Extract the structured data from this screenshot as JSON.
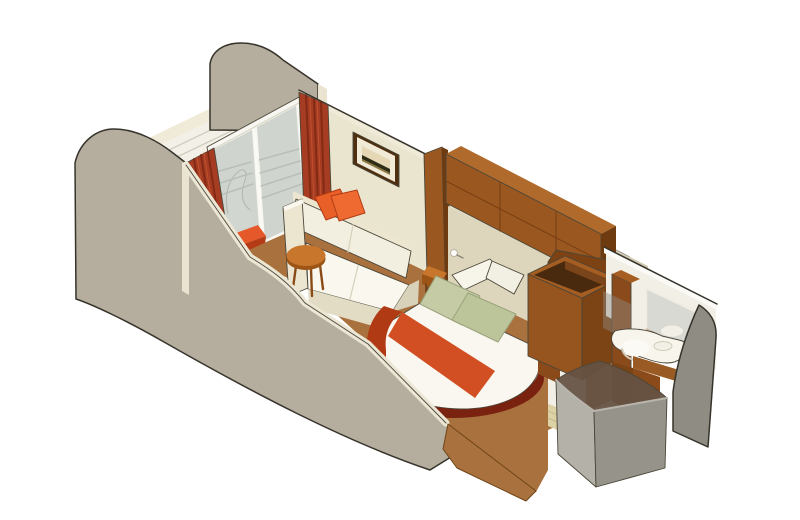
{
  "scene": {
    "type": "isometric-cutaway-illustration",
    "subject": "cruise-ship-balcony-stateroom",
    "objects": [
      "private balcony with slatted deck and curved privacy partitions",
      "sliding glass balcony door with white frame",
      "white lounge chair and orange chair on balcony",
      "red drapes on both sides of balcony door",
      "framed landscape wall art",
      "cream sofa with two orange accent pillows",
      "round wooden coffee table",
      "wood headboard wall with overhead storage cabinets and reading lamp",
      "bedside shelf",
      "bed with white duvet, orange runner, green and white pillows, rounded foot platform",
      "open-top wardrobe / storage unit",
      "bathroom with wood vanity, oval sink and mirror",
      "curved glass shower enclosure",
      "brown carpet in cabin, tiled bathroom floor",
      "cutaway foreground walls"
    ]
  },
  "colors": {
    "bg": "#ffffff",
    "partition": "#b5ae9e",
    "partition_edge": "#e9e3cf",
    "deck": "#f3f1e7",
    "wall": "#eae5cf",
    "wall_dark": "#d2cbb0",
    "wall_edge": "#f0ebd9",
    "glass": "#a8b2ac",
    "door_frame": "#f7f6f0",
    "curtain": "#a63c22",
    "carpet": "#a9713d",
    "frame_wood": "#4e3010",
    "frame_mat": "#f1ead6",
    "art_sky": "#e6d8b4",
    "art_dark": "#2e2c14",
    "art_ground": "#8a7840",
    "sofa_cream": "#ece6d0",
    "sofa_seat": "#f9f7ee",
    "sofa_back": "#f2efe0",
    "sofa_base": "#e2dcc4",
    "sofa_side": "#d8d2ba",
    "pillow_orange": "#e85f28",
    "pillow_orange2": "#ef6a30",
    "table_top": "#c8762c",
    "table_edge": "#9c5517",
    "wood_front": "#9a5820",
    "wood_top": "#b06a2c",
    "wood_dark": "#6e3a10",
    "headboard_panel": "#ddd6bc",
    "lamp": "#fdfcf8",
    "bed_white": "#f9f7ef",
    "bed_base": "#efece0",
    "bed_shadow": "#7a2210",
    "runner": "#d14f22",
    "runner_dark": "#b03a14",
    "pillow_green": "#c5cba4",
    "pillow_green2": "#bcc49a",
    "pillow_white": "#f7f5ea",
    "pillow_white2": "#f2f0e2",
    "wardrobe_face": "#96541e",
    "wardrobe_side": "#7c4314",
    "wardrobe_rim": "#a55d22",
    "wardrobe_inside": "#4a2a0e",
    "wardrobe_inner": "#7a451a",
    "divider_wood": "#7c4214",
    "panel_wood": "#8a4a1a",
    "bath_white": "#f2f0e6",
    "bath_band": "#fbfaf6",
    "mirror": "#d9d9d4",
    "mirror_wood": "#b98a58",
    "vanity_wood": "#8a4a1c",
    "vanity_apron": "#9a5a24",
    "counter": "#f7f5ec",
    "sink": "#fbfaf4",
    "tile": "#ddd2a6",
    "gray_wall": "#8f8c83",
    "shower_left": "#b4b1a8",
    "shower_right": "#96938a",
    "shower_glass": "#655244",
    "chair_white": "#fbfaf6",
    "chair_orange": "#e4582a",
    "chair_orange_dark": "#b53b16"
  }
}
